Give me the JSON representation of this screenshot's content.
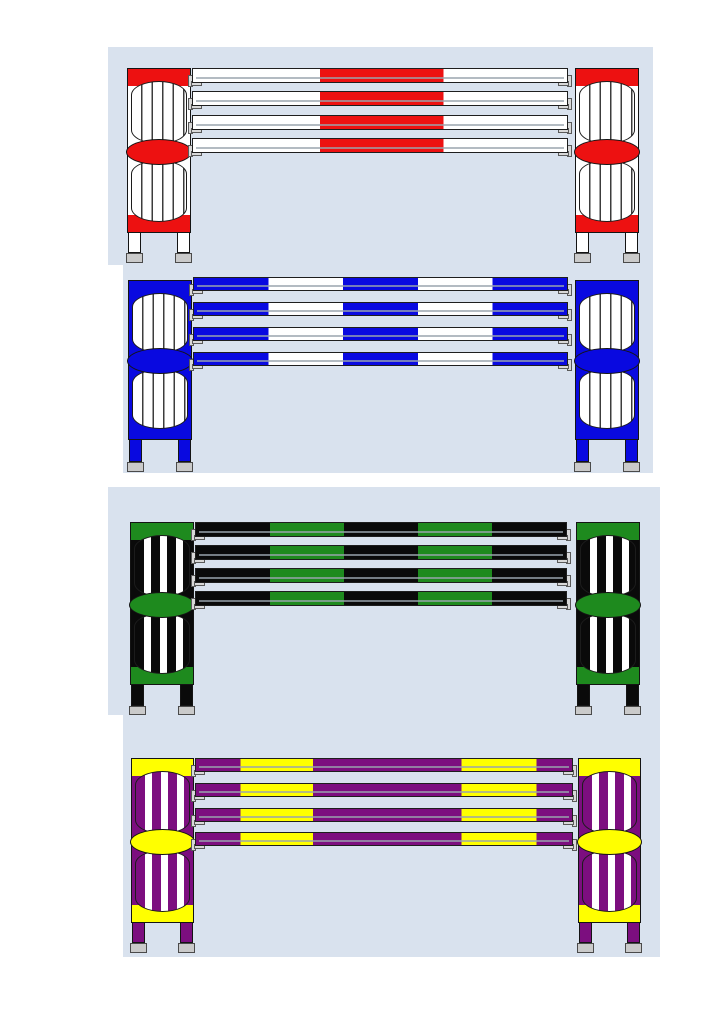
{
  "page": {
    "title": "Show jump colour schemes sheet",
    "background_color": "#ffffff",
    "panel_color": "#d9e2ee"
  },
  "hardware": {
    "foot_color": "#cacaca",
    "cup_color": "#d8d8d8",
    "outline_color": "#141414",
    "rail_shading_color": "#9aa4ae"
  },
  "jumps": [
    {
      "id": "red-white",
      "name": "Red and white jump",
      "frame_color": "#ffffff",
      "accent_color": "#ed1111",
      "slat_style": "pinstripe",
      "slat_color": "#3c3c3c",
      "window_color": "#ffffff",
      "rail_count": 4,
      "rail_segments": [
        {
          "color": "#ffffff",
          "frac": 0.34
        },
        {
          "color": "#ed1111",
          "frac": 0.33
        },
        {
          "color": "#ffffff",
          "frac": 0.33
        }
      ]
    },
    {
      "id": "blue-white",
      "name": "Blue and white jump",
      "frame_color": "#0909e0",
      "accent_color": "#0909e0",
      "slat_style": "pinstripe",
      "slat_color": "#3c3c3c",
      "window_color": "#ffffff",
      "rail_count": 4,
      "rail_segments": [
        {
          "color": "#0909e0",
          "frac": 0.2
        },
        {
          "color": "#ffffff",
          "frac": 0.2
        },
        {
          "color": "#0909e0",
          "frac": 0.2
        },
        {
          "color": "#ffffff",
          "frac": 0.2
        },
        {
          "color": "#0909e0",
          "frac": 0.2
        }
      ]
    },
    {
      "id": "green-black",
      "name": "Green and black jump",
      "frame_color": "#0a0a0a",
      "accent_color": "#1e8a1e",
      "slat_style": "bold",
      "slat_color": "#0a0a0a",
      "window_color": "#ffffff",
      "rail_count": 4,
      "rail_segments": [
        {
          "color": "#0a0a0a",
          "frac": 0.2
        },
        {
          "color": "#1e8a1e",
          "frac": 0.2
        },
        {
          "color": "#0a0a0a",
          "frac": 0.2
        },
        {
          "color": "#1e8a1e",
          "frac": 0.2
        },
        {
          "color": "#0a0a0a",
          "frac": 0.2
        }
      ]
    },
    {
      "id": "purple-yellow",
      "name": "Purple and yellow jump",
      "frame_color": "#7c0e7f",
      "accent_color": "#ffff00",
      "slat_style": "bold",
      "slat_color": "#7c0e7f",
      "window_color": "#ffffff",
      "rail_count": 4,
      "rail_segments": [
        {
          "color": "#7c0e7f",
          "frac": 0.118
        },
        {
          "color": "#ffff00",
          "frac": 0.193
        },
        {
          "color": "#7c0e7f",
          "frac": 0.395
        },
        {
          "color": "#ffff00",
          "frac": 0.2
        },
        {
          "color": "#7c0e7f",
          "frac": 0.094
        }
      ]
    }
  ]
}
